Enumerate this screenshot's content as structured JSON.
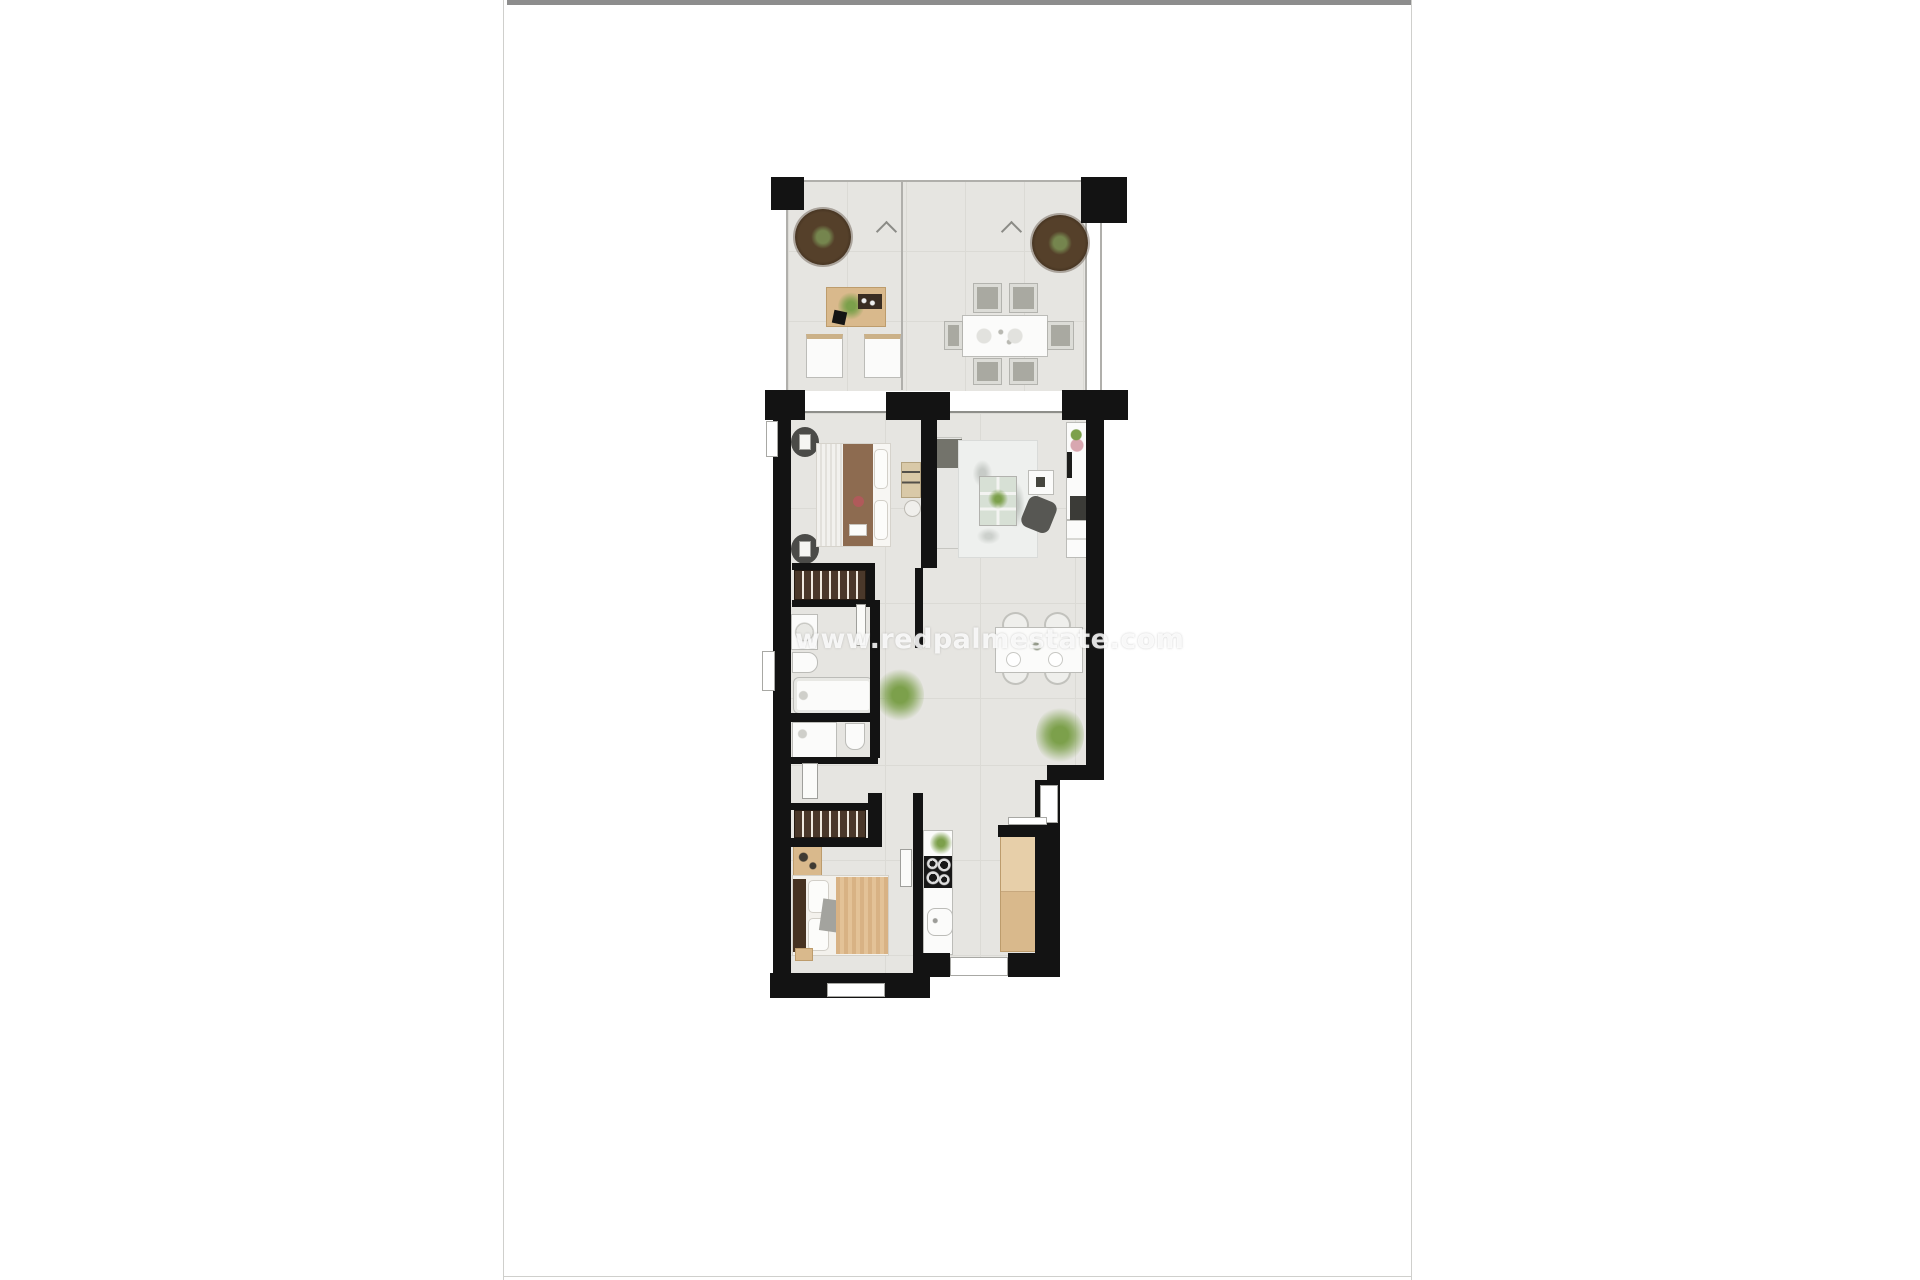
{
  "page": {
    "background": "#ffffff",
    "topbar_color": "#8d8d8d",
    "edge_color": "#cfcfcc"
  },
  "watermark": {
    "text": "www.redpalmestate.com",
    "color": "rgba(255,255,255,0.85)"
  },
  "palette": {
    "wall": "#131313",
    "floor": "#e6e5e1",
    "floorline": "#dbdad5",
    "fixture": "#fbfbfa",
    "fixtureborder": "#bcbcb8",
    "wood": "#d9b98c",
    "wardrobe": "#4a382a",
    "topbar": "#8d8d8d",
    "edge": "#cfcfcc",
    "wmcolor": "rgba(255,255,255,0.85)"
  }
}
